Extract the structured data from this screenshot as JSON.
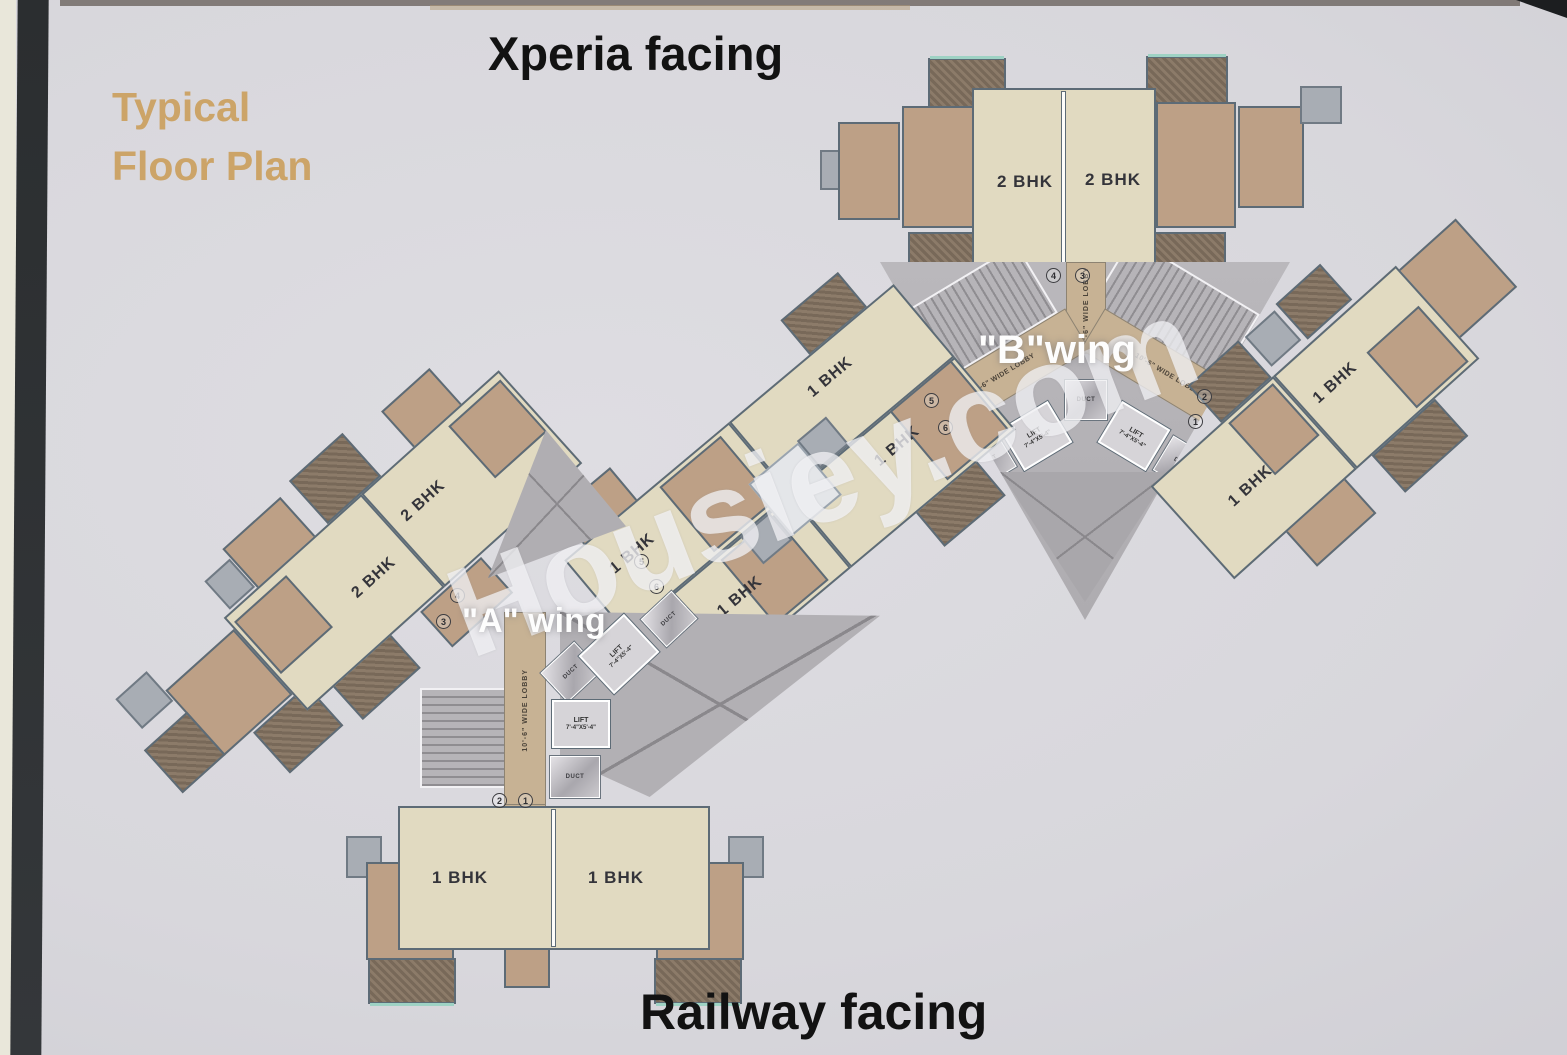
{
  "scene": {
    "title_line1": "Typical",
    "title_line2": "Floor Plan",
    "top_facing": "Xperia facing",
    "bottom_facing": "Railway facing",
    "watermark": "Housiey.com",
    "wing_a_label": "\"A\" wing",
    "wing_b_label": "\"B\"wing"
  },
  "units": {
    "b_top_block": [
      "2 BHK",
      "2 BHK"
    ],
    "a_sw_arm": [
      "2 BHK",
      "2 BHK"
    ],
    "mid_band": [
      "1 BHK",
      "1 BHK",
      "1 BHK",
      "1 BHK"
    ],
    "b_ne_arm": [
      "1 BHK",
      "1 BHK"
    ],
    "a_south_block": [
      "1 BHK",
      "1 BHK"
    ]
  },
  "core": {
    "lift_label": "LIFT",
    "lift_size": "7'-4\"X5'-4\"",
    "duct_label": "DUCT",
    "lobby_label": "10'-6\" WIDE LOBBY"
  },
  "flat_numbers": {
    "b_top": [
      "4",
      "3"
    ],
    "b_core_left": [
      "5",
      "6"
    ],
    "b_core_right": [
      "2",
      "1"
    ],
    "a_arm": [
      "4",
      "3"
    ],
    "a_mid": [
      "5",
      "6"
    ],
    "a_bottom": [
      "2",
      "1"
    ]
  },
  "colors": {
    "paper": "#d9d8dd",
    "title_gold": "#cba05f",
    "room_beige": "#e1dac1",
    "corridor_tan": "#c7b294",
    "balcony_brown": "#bda086",
    "balcony_dark": "#8c7b69",
    "slab_gray": "#a8adb4",
    "core_gray": "#b5b3b9",
    "wall": "#5d6b76",
    "window_teal": "#9ed2c4",
    "photo_edge_black": "#2d3032"
  }
}
